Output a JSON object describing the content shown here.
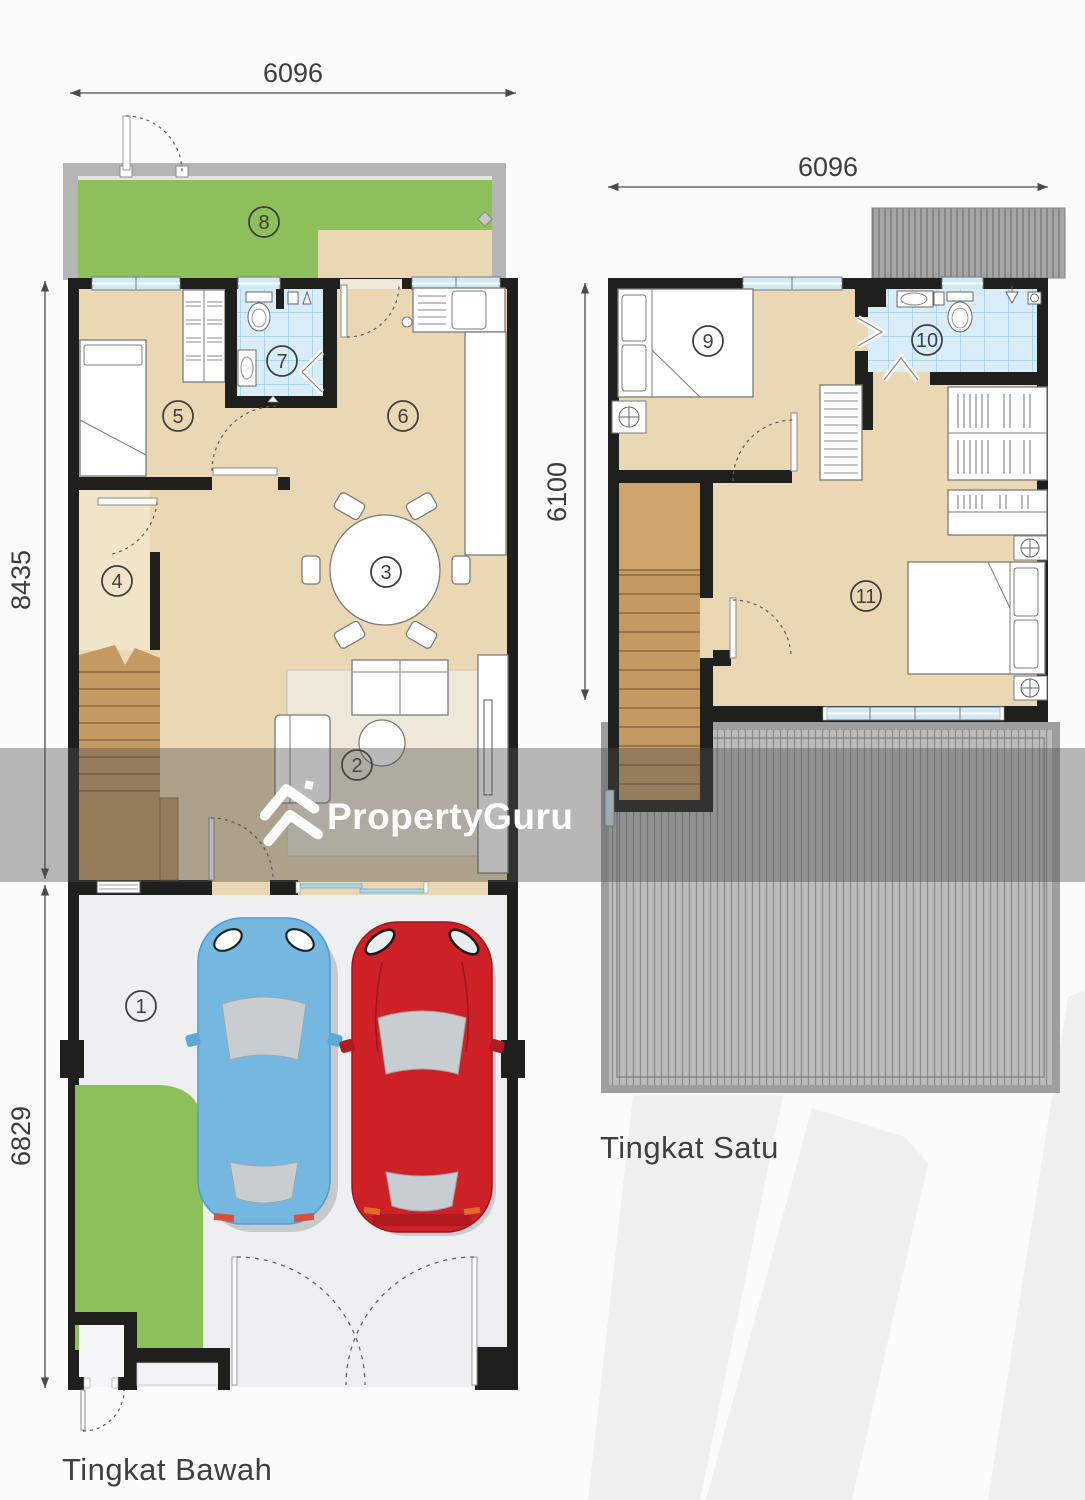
{
  "ground_floor": {
    "name_label": "Tingkat Bawah",
    "width_dim": "6096",
    "upper_height_dim": "8435",
    "lower_height_dim": "6829"
  },
  "first_floor": {
    "name_label": "Tingkat Satu",
    "width_dim": "6096",
    "height_dim": "6100"
  },
  "room_numbers": {
    "r1": "1",
    "r2": "2",
    "r3": "3",
    "r4": "4",
    "r5": "5",
    "r6": "6",
    "r7": "7",
    "r8": "8",
    "r9": "9",
    "r10": "10",
    "r11": "11"
  },
  "watermark": {
    "brand": "PropertyGuru"
  },
  "palette": {
    "wall_black": "#1f1f1d",
    "floor_beige": "#ead7b3",
    "hall_beige": "#f0e5c9",
    "grass_green": "#8dc05a",
    "tile_blue": "#d9edf8",
    "stair_brown": "#c49a63",
    "roof_gray": "#bcbcbc",
    "garage_gray": "#edeff1",
    "fence_gray": "#b5b5b5",
    "car_blue": "#74b7e1",
    "car_red": "#ce2127",
    "window_blue": "#cfe9f6",
    "dim_text": "#3d3d3d"
  }
}
